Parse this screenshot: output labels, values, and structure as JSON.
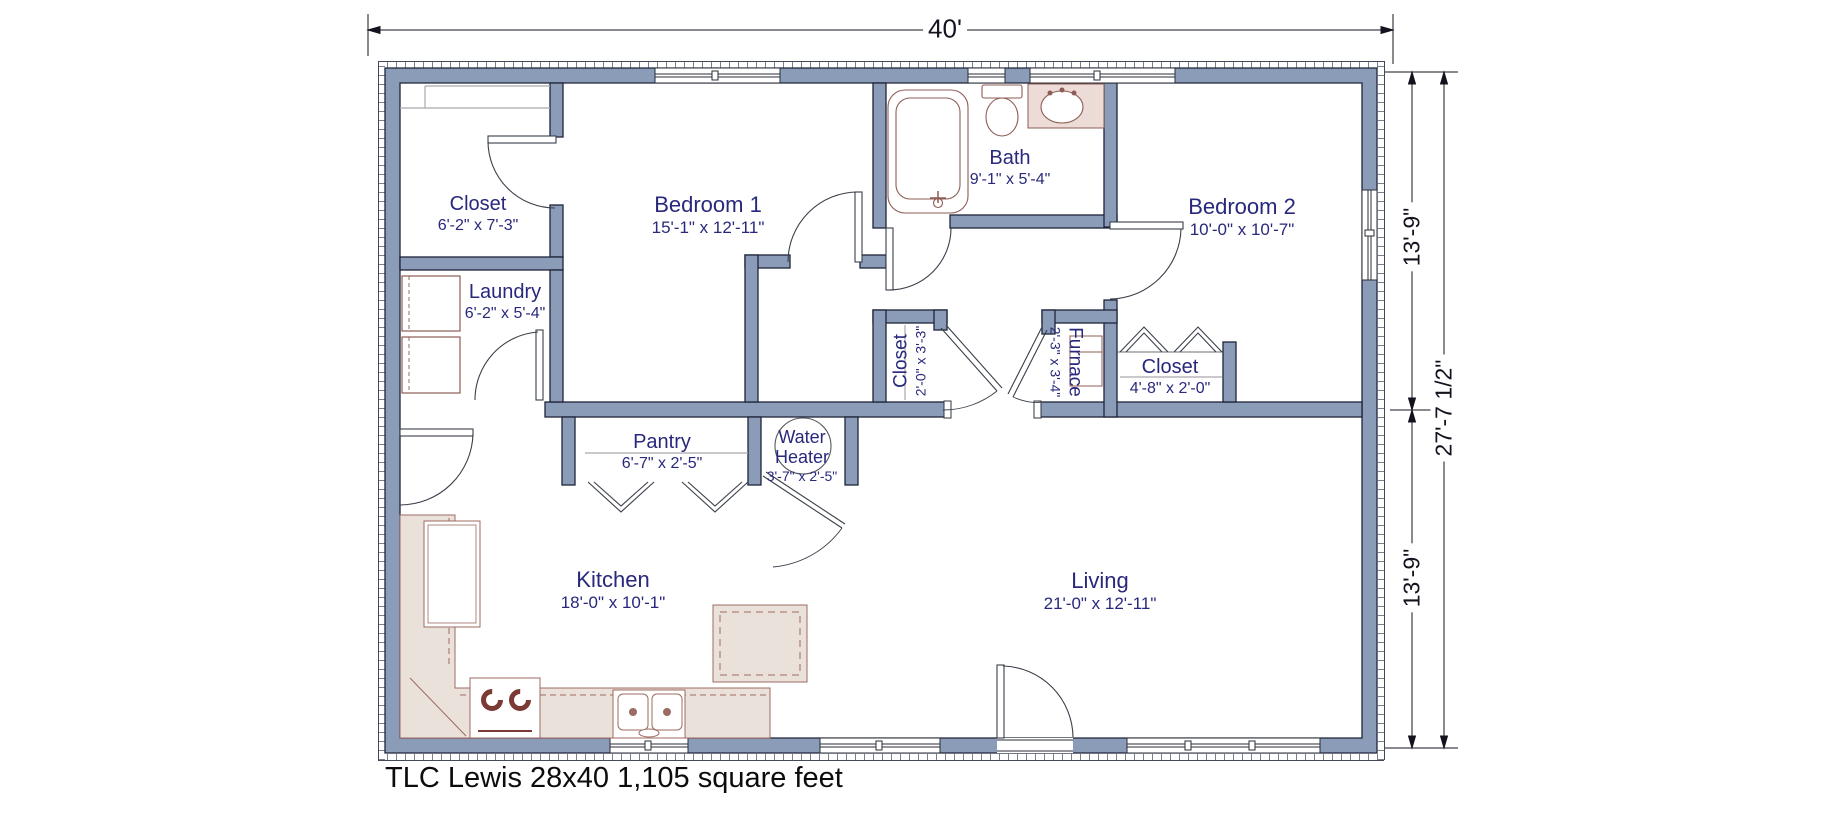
{
  "title": "TLC Lewis 28x40 1,105 square feet",
  "dimensions": {
    "top_width": "40'",
    "right_upper": "13'-9\"",
    "right_total": "27'-7 1/2\"",
    "right_lower": "13'-9\""
  },
  "rooms": {
    "closet_tl": {
      "name": "Closet",
      "dims": "6'-2\" x 7'-3\""
    },
    "bedroom1": {
      "name": "Bedroom 1",
      "dims": "15'-1\" x 12'-11\""
    },
    "laundry": {
      "name": "Laundry",
      "dims": "6'-2\" x 5'-4\""
    },
    "bath": {
      "name": "Bath",
      "dims": "9'-1\" x 5'-4\""
    },
    "bedroom2": {
      "name": "Bedroom 2",
      "dims": "10'-0\" x 10'-7\""
    },
    "hall_closet": {
      "name": "Closet",
      "dims": "2'-0\" x 3'-3\""
    },
    "furnace": {
      "name": "Furnace",
      "dims": "2'-3\" x 3'-4\""
    },
    "closet2": {
      "name": "Closet",
      "dims": "4'-8\" x 2'-0\""
    },
    "pantry": {
      "name": "Pantry",
      "dims": "6'-7\" x 2'-5\""
    },
    "water_heater": {
      "name_line1": "Water",
      "name_line2": "Heater",
      "dims": "3'-7\" x 2'-5\""
    },
    "kitchen": {
      "name": "Kitchen",
      "dims": "18'-0\" x 10'-1\""
    },
    "living": {
      "name": "Living",
      "dims": "21'-0\" x 12'-11\""
    }
  },
  "colors": {
    "wall_fill": "#8a9cb8",
    "wall_line": "#1e2438",
    "room_text": "#28287c",
    "fixture_line": "#8d5c54",
    "counter_fill": "#ebe1db",
    "dim_text": "#13131f"
  }
}
